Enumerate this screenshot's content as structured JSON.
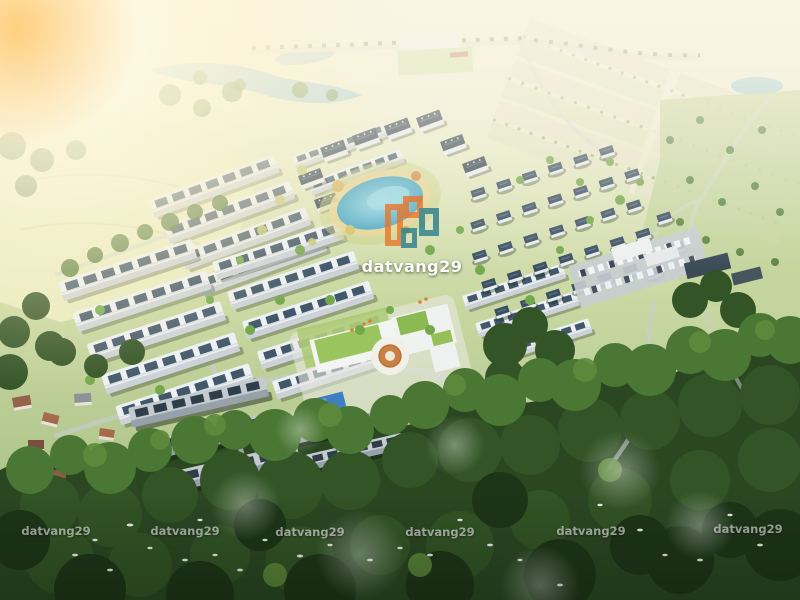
{
  "image": {
    "type": "aerial-3d-render",
    "subject": "residential master-planned community with townhouse rows, villa grid, lagoon pool, ring clubhouse, parking lot and surrounding forest"
  },
  "watermark": {
    "text": "datvang29",
    "center_logo": "overlapping-building-outlines-logo",
    "small_instances": 6,
    "logo_colors": {
      "orange": "#e8762a",
      "teal": "#2a7d8c"
    },
    "text_color": "#ffffff"
  },
  "colors": {
    "sun_flare": "#fff3d6",
    "haze": "#f6f2e0",
    "open_field": "#e9ecc2",
    "meadow": "#c3d49c",
    "lake_water": "#8fc3d9",
    "lagoon_pool": "#56b4cd",
    "clubhouse_pool": "#3d7fc0",
    "townhouse_roof": "#edf1f4",
    "roof_solar_strip": "#42586a",
    "villa_roof": "#3c4f62",
    "village_roof": "#96604a",
    "clubhouse_green_roof": "#9ac45e",
    "courtyard_orange": "#c98244",
    "road": "#ccd2d6",
    "forest_dark": "#1d3517",
    "forest_mid": "#325426",
    "forest_light": "#4a7733",
    "bird": "#ffffff"
  },
  "scene": {
    "elements": [
      "sun-flare",
      "lakes",
      "land-plots-grid",
      "open-field",
      "tree-lined-roads",
      "sports-field",
      "townhouse-rows",
      "villa-grid",
      "apartment-blocks",
      "lagoon-pool",
      "clubhouse-ring-building",
      "clubhouse-pool",
      "parking-lot",
      "commercial-buildings",
      "village-houses",
      "forest-canopy",
      "white-birds",
      "winding-roads"
    ]
  }
}
